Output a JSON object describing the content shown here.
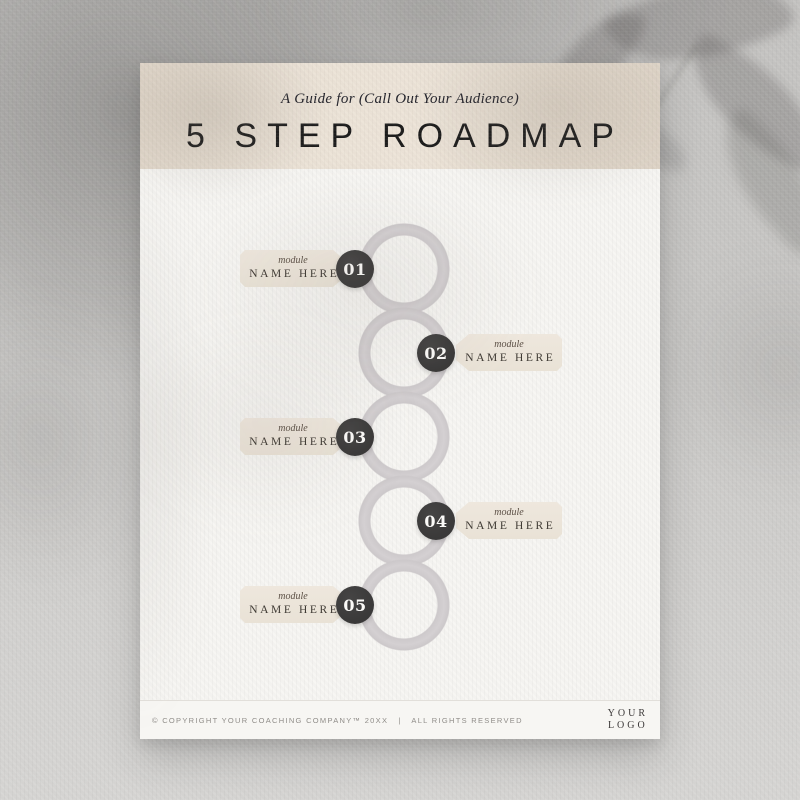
{
  "colors": {
    "header_beige": "#e9e0d4",
    "tag_beige": "#ebe4d9",
    "ring_gray": "#d1cdcf",
    "badge_charcoal": "#3b3a3a",
    "page_white": "#f7f6f3"
  },
  "header": {
    "subtitle": "A Guide for (Call Out Your Audience)",
    "title": "5 STEP ROADMAP"
  },
  "steps": [
    {
      "number": "01",
      "side": "left",
      "label_top": "module",
      "label_main": "NAME HERE"
    },
    {
      "number": "02",
      "side": "right",
      "label_top": "module",
      "label_main": "NAME HERE"
    },
    {
      "number": "03",
      "side": "left",
      "label_top": "module",
      "label_main": "NAME HERE"
    },
    {
      "number": "04",
      "side": "right",
      "label_top": "module",
      "label_main": "NAME HERE"
    },
    {
      "number": "05",
      "side": "left",
      "label_top": "module",
      "label_main": "NAME HERE"
    }
  ],
  "footer": {
    "copyright": "© COPYRIGHT YOUR COACHING COMPANY™ 20XX   |   ALL RIGHTS RESERVED",
    "logo_line1": "YOUR",
    "logo_line2": "LOGO"
  }
}
